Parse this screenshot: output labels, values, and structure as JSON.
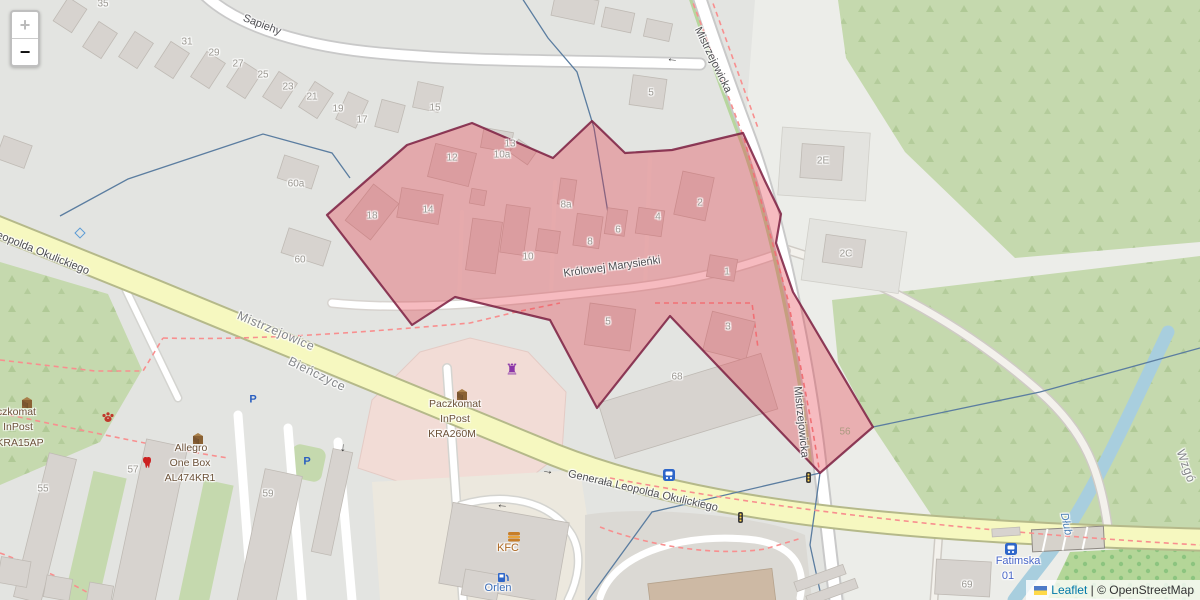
{
  "zoom_control": {
    "zoom_in": "+",
    "zoom_out": "−"
  },
  "attribution": {
    "leaflet_label": "Leaflet",
    "separator": " | ",
    "osm_label": "© OpenStreetMap"
  },
  "colors": {
    "polygon_fill": "#e43041",
    "polygon_stroke": "#7b1f41",
    "road_secondary": "#f6f8c0",
    "road_casing": "#b5b98a",
    "green_area": "#c5d9ae",
    "water": "#a8cede",
    "building": "#d7d3cf"
  },
  "map_labels": [
    {
      "name": "street-sapiehy",
      "text": "Sapiehy",
      "x": 262,
      "y": 25,
      "rot": 21,
      "cls": "street"
    },
    {
      "name": "street-okulickiego-nw",
      "text": "Leopolda Okulickiego",
      "x": 40,
      "y": 252,
      "rot": 22,
      "cls": "street"
    },
    {
      "name": "street-okulickiego",
      "text": "Generała Leopolda Okulickiego",
      "x": 643,
      "y": 491,
      "rot": 13,
      "cls": "street"
    },
    {
      "name": "street-marysienki",
      "text": "Królowej Marysieńki",
      "x": 612,
      "y": 267,
      "rot": -8,
      "cls": "street"
    },
    {
      "name": "street-mistrzejowicka-n",
      "text": "Mistrzejowicka",
      "x": 713,
      "y": 60,
      "rot": 64,
      "cls": "street"
    },
    {
      "name": "street-mistrzejowicka-s",
      "text": "Mistrzejowicka",
      "x": 801,
      "y": 422,
      "rot": 84,
      "cls": "street"
    },
    {
      "name": "district-mistrzejowice",
      "text": "Mistrzejowice",
      "x": 276,
      "y": 331,
      "rot": 23,
      "cls": "district"
    },
    {
      "name": "district-bienczyce",
      "text": "Bieńczyce",
      "x": 317,
      "y": 374,
      "rot": 26,
      "cls": "district"
    },
    {
      "name": "district-wzgorza",
      "text": "Wzgó",
      "x": 1186,
      "y": 466,
      "rot": 70,
      "cls": "district"
    },
    {
      "name": "water-dlubnia",
      "text": "Dłub",
      "x": 1066,
      "y": 524,
      "rot": 78,
      "cls": "water"
    },
    {
      "name": "num-35",
      "text": "35",
      "x": 103,
      "y": 4,
      "rot": 0,
      "cls": "num"
    },
    {
      "name": "num-31",
      "text": "31",
      "x": 187,
      "y": 42,
      "rot": 0,
      "cls": "num"
    },
    {
      "name": "num-29",
      "text": "29",
      "x": 214,
      "y": 53,
      "rot": 0,
      "cls": "num"
    },
    {
      "name": "num-27",
      "text": "27",
      "x": 238,
      "y": 64,
      "rot": 0,
      "cls": "num"
    },
    {
      "name": "num-25",
      "text": "25",
      "x": 263,
      "y": 75,
      "rot": 0,
      "cls": "num"
    },
    {
      "name": "num-23",
      "text": "23",
      "x": 288,
      "y": 87,
      "rot": 0,
      "cls": "num"
    },
    {
      "name": "num-21",
      "text": "21",
      "x": 312,
      "y": 97,
      "rot": 0,
      "cls": "num"
    },
    {
      "name": "num-19",
      "text": "19",
      "x": 338,
      "y": 109,
      "rot": 0,
      "cls": "num"
    },
    {
      "name": "num-17",
      "text": "17",
      "x": 362,
      "y": 120,
      "rot": 0,
      "cls": "num"
    },
    {
      "name": "num-15",
      "text": "15",
      "x": 435,
      "y": 108,
      "rot": 0,
      "cls": "num"
    },
    {
      "name": "num-60a",
      "text": "60a",
      "x": 296,
      "y": 184,
      "rot": 0,
      "cls": "num"
    },
    {
      "name": "num-60",
      "text": "60",
      "x": 300,
      "y": 260,
      "rot": 0,
      "cls": "num"
    },
    {
      "name": "num-5-top",
      "text": "5",
      "x": 651,
      "y": 93,
      "rot": 0,
      "cls": "num"
    },
    {
      "name": "num-13",
      "text": "13",
      "x": 510,
      "y": 144,
      "rot": 0,
      "cls": "num"
    },
    {
      "name": "num-10a",
      "text": "10a",
      "x": 502,
      "y": 155,
      "rot": 0,
      "cls": "num"
    },
    {
      "name": "num-12",
      "text": "12",
      "x": 452,
      "y": 158,
      "rot": 0,
      "cls": "num"
    },
    {
      "name": "num-18",
      "text": "18",
      "x": 372,
      "y": 216,
      "rot": 0,
      "cls": "num"
    },
    {
      "name": "num-14",
      "text": "14",
      "x": 428,
      "y": 210,
      "rot": 0,
      "cls": "num"
    },
    {
      "name": "num-10",
      "text": "10",
      "x": 528,
      "y": 257,
      "rot": 0,
      "cls": "num"
    },
    {
      "name": "num-8a",
      "text": "8a",
      "x": 566,
      "y": 205,
      "rot": 0,
      "cls": "num"
    },
    {
      "name": "num-8",
      "text": "8",
      "x": 590,
      "y": 242,
      "rot": 0,
      "cls": "num"
    },
    {
      "name": "num-6",
      "text": "6",
      "x": 618,
      "y": 230,
      "rot": 0,
      "cls": "num"
    },
    {
      "name": "num-4",
      "text": "4",
      "x": 658,
      "y": 217,
      "rot": 0,
      "cls": "num"
    },
    {
      "name": "num-2",
      "text": "2",
      "x": 700,
      "y": 203,
      "rot": 0,
      "cls": "num"
    },
    {
      "name": "num-1",
      "text": "1",
      "x": 727,
      "y": 272,
      "rot": 0,
      "cls": "num"
    },
    {
      "name": "num-5-south",
      "text": "5",
      "x": 608,
      "y": 322,
      "rot": 0,
      "cls": "num"
    },
    {
      "name": "num-3",
      "text": "3",
      "x": 728,
      "y": 327,
      "rot": 0,
      "cls": "num"
    },
    {
      "name": "num-68",
      "text": "68",
      "x": 677,
      "y": 377,
      "rot": 0,
      "cls": "num"
    },
    {
      "name": "num-2e",
      "text": "2E",
      "x": 823,
      "y": 161,
      "rot": 0,
      "cls": "num"
    },
    {
      "name": "num-2c",
      "text": "2C",
      "x": 846,
      "y": 254,
      "rot": 0,
      "cls": "num"
    },
    {
      "name": "num-56",
      "text": "56",
      "x": 845,
      "y": 432,
      "rot": 0,
      "cls": "numfaint"
    },
    {
      "name": "num-55",
      "text": "55",
      "x": 43,
      "y": 489,
      "rot": 0,
      "cls": "num"
    },
    {
      "name": "num-57",
      "text": "57",
      "x": 133,
      "y": 470,
      "rot": 0,
      "cls": "num"
    },
    {
      "name": "num-59",
      "text": "59",
      "x": 268,
      "y": 494,
      "rot": 0,
      "cls": "num"
    },
    {
      "name": "num-69",
      "text": "69",
      "x": 967,
      "y": 585,
      "rot": 0,
      "cls": "num"
    },
    {
      "name": "poi-kra15ap-line1",
      "text": "Paczkomat",
      "x": 10,
      "y": 412,
      "rot": 0,
      "cls": "poi"
    },
    {
      "name": "poi-kra15ap-line2",
      "text": "InPost",
      "x": 18,
      "y": 427,
      "rot": 0,
      "cls": "poi"
    },
    {
      "name": "poi-kra15ap-line3",
      "text": "KRA15AP",
      "x": 20,
      "y": 443,
      "rot": 0,
      "cls": "poi"
    },
    {
      "name": "poi-allegro-line1",
      "text": "Allegro",
      "x": 191,
      "y": 448,
      "rot": 0,
      "cls": "poi"
    },
    {
      "name": "poi-allegro-line2",
      "text": "One Box",
      "x": 190,
      "y": 463,
      "rot": 0,
      "cls": "poi"
    },
    {
      "name": "poi-allegro-line3",
      "text": "AL474KR1",
      "x": 190,
      "y": 478,
      "rot": 0,
      "cls": "poi"
    },
    {
      "name": "poi-kra260m-line1",
      "text": "Paczkomat",
      "x": 455,
      "y": 404,
      "rot": 0,
      "cls": "poi"
    },
    {
      "name": "poi-kra260m-line2",
      "text": "InPost",
      "x": 455,
      "y": 419,
      "rot": 0,
      "cls": "poi"
    },
    {
      "name": "poi-kra260m-line3",
      "text": "KRA260M",
      "x": 452,
      "y": 434,
      "rot": 0,
      "cls": "poi"
    },
    {
      "name": "poi-kfc",
      "text": "KFC",
      "x": 508,
      "y": 548,
      "rot": 0,
      "cls": "poi-orange"
    },
    {
      "name": "poi-orlen",
      "text": "Orlen",
      "x": 498,
      "y": 588,
      "rot": 0,
      "cls": "poi-blue"
    },
    {
      "name": "transit-fatimska",
      "text": "Fatimska",
      "x": 1018,
      "y": 561,
      "rot": 0,
      "cls": "transit"
    },
    {
      "name": "transit-fatimska-01",
      "text": "01",
      "x": 1008,
      "y": 576,
      "rot": 0,
      "cls": "transit"
    }
  ]
}
